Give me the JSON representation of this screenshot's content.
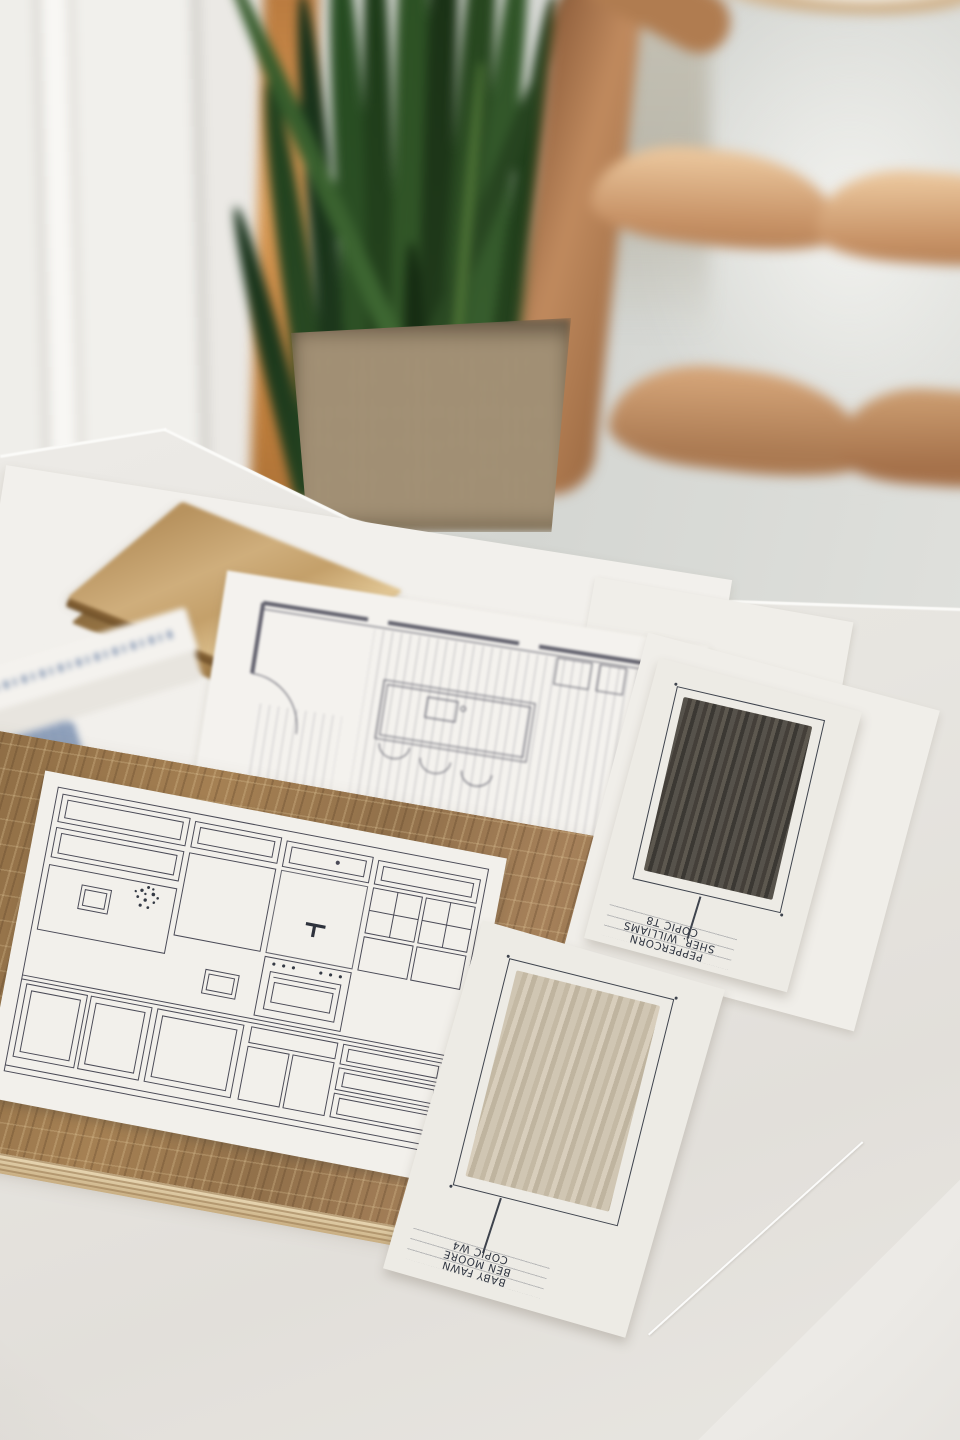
{
  "meta": {
    "description": "Photograph of an interior-design mood board: kitchen elevation and floor-plan drawings, an oak wood sample board, brass metal squares, and two hand-painted paint swatch cards on a white paper-covered table; snake plant in a woven basket and a wooden ladder-back chair in the blurred background."
  },
  "swatch_cards": [
    {
      "id": "peppercorn",
      "label_lines": [
        "PEPPERCORN",
        "SHER. WILLIAMS",
        "COPIC T8"
      ],
      "swatch_color": "#4b4741"
    },
    {
      "id": "baby-fawn",
      "label_lines": [
        "BABY FAWN",
        "BEN MOORE",
        "COPIC W4"
      ],
      "swatch_color": "#cbc0ad"
    }
  ],
  "palette": {
    "wall": "#d9dad6",
    "table_paper": "#e9e7e3",
    "oak_board": "#95744b",
    "plywood_edge": "#e2d1ac",
    "brass": "#c2a06c",
    "plant_green": "#2f4c27",
    "basket": "#a8967a",
    "chair_wood": "#c28f63",
    "ink": "#3e434d",
    "card_white": "#edebe5"
  }
}
